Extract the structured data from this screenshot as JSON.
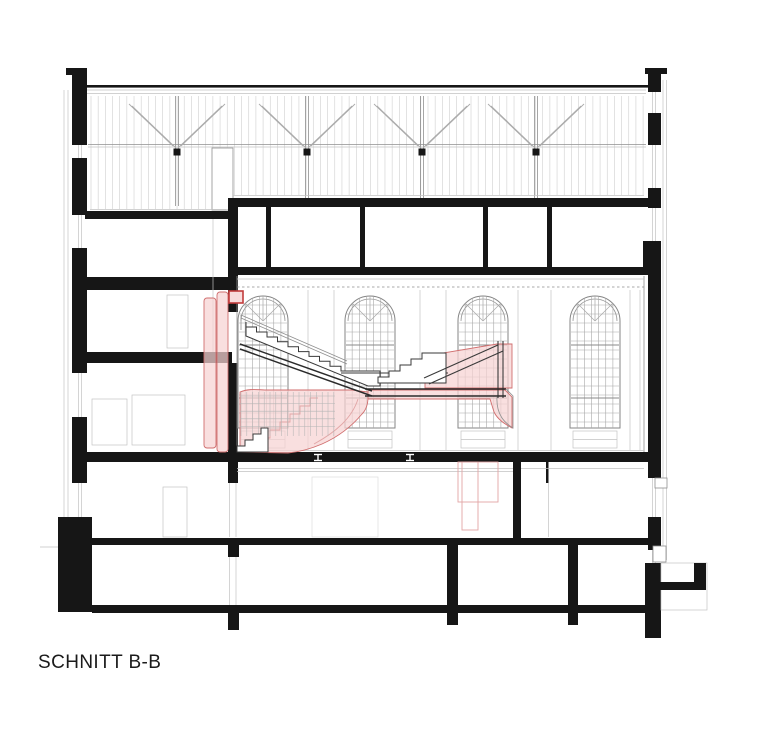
{
  "sheet": {
    "title": "SCHNITT B-B"
  },
  "palette": {
    "section_cut": "#161616",
    "line_light": "#c2c2c2",
    "line_medium": "#8f8f8f",
    "line_dark": "#3a3a3a",
    "highlight_fill": "#f6d2d2",
    "highlight_stroke": "#d06e6e",
    "highlight_accent": "#c23b3b",
    "paper": "#ffffff"
  }
}
